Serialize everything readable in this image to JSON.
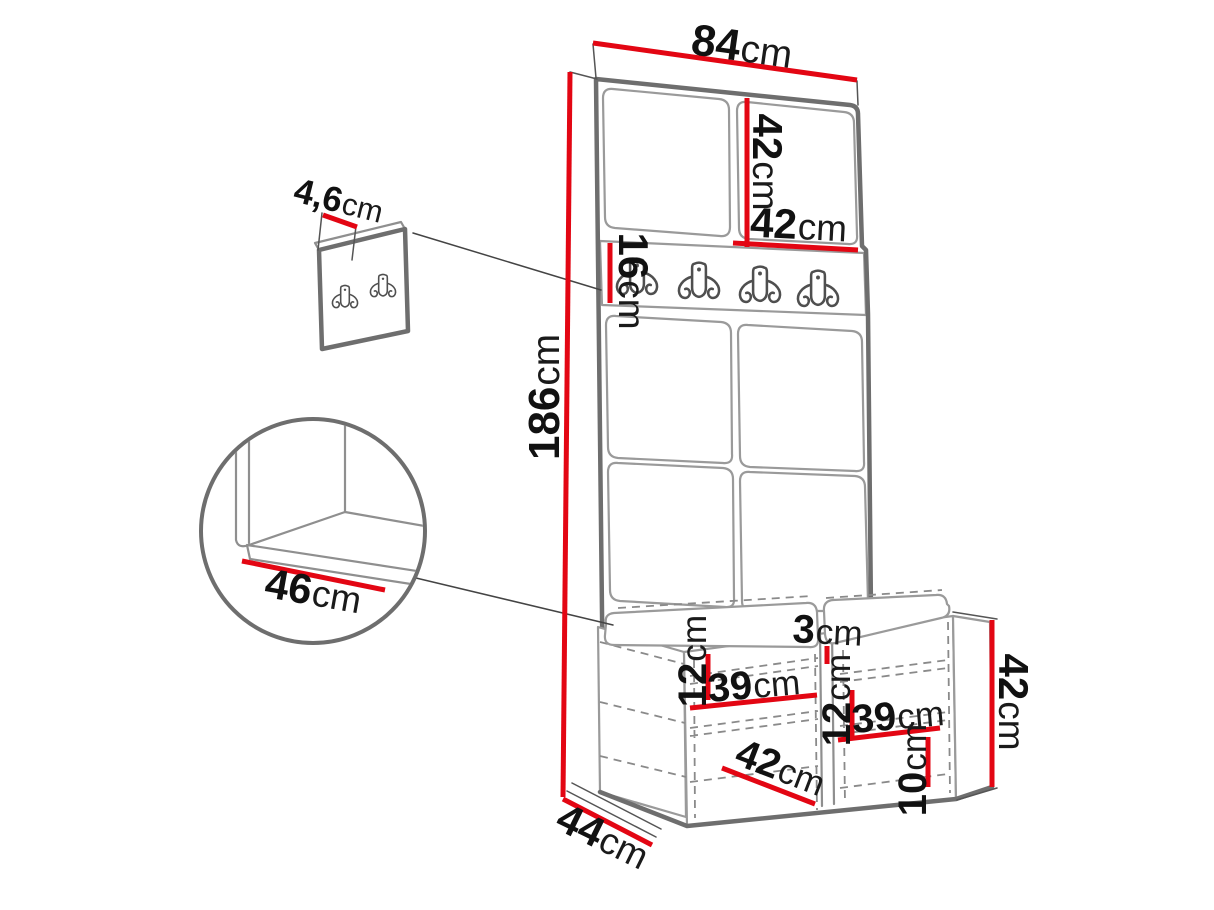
{
  "diagram": {
    "kind": "furniture-dimension-diagram",
    "colors": {
      "dimension_red": "#e30613",
      "outline_gray": "#6e6e6e",
      "thin_line_gray": "#9a9a9a",
      "text": "#111111"
    },
    "dims": {
      "overall_width": {
        "value": "84",
        "unit": "cm"
      },
      "top_panel_h": {
        "value": "42",
        "unit": "cm"
      },
      "top_panel_w": {
        "value": "42",
        "unit": "cm"
      },
      "rail_h": {
        "value": "16",
        "unit": "cm"
      },
      "overall_h": {
        "value": "186",
        "unit": "cm"
      },
      "panel_thickness": {
        "value": "4,6",
        "unit": "cm"
      },
      "seat_depth": {
        "value": "46",
        "unit": "cm"
      },
      "left_gap": {
        "value": "12",
        "unit": "cm"
      },
      "left_w": {
        "value": "39",
        "unit": "cm"
      },
      "divider": {
        "value": "3",
        "unit": "cm"
      },
      "right_gap": {
        "value": "12",
        "unit": "cm"
      },
      "right_w": {
        "value": "39",
        "unit": "cm"
      },
      "bottom_gap": {
        "value": "10",
        "unit": "cm"
      },
      "inner_w": {
        "value": "42",
        "unit": "cm"
      },
      "bench_h": {
        "value": "42",
        "unit": "cm"
      },
      "bench_depth": {
        "value": "44",
        "unit": "cm"
      }
    }
  }
}
